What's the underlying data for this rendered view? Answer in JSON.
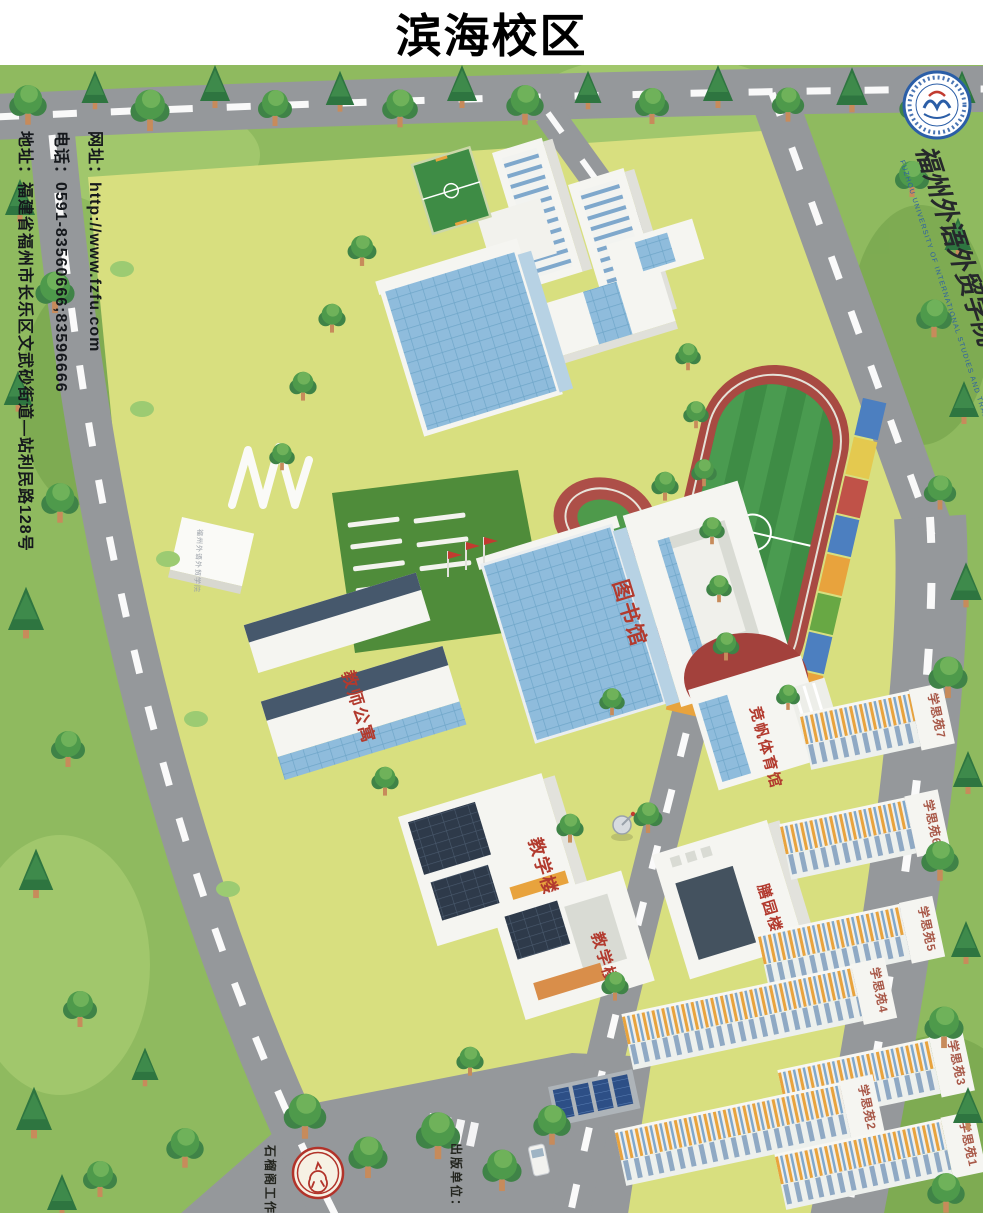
{
  "header": {
    "title": "滨海校区"
  },
  "contact": {
    "website": "网址：http://www.fzfu.com",
    "phone": "电话：0591-83560666;83596666",
    "address": "地址：福建省福州市长乐区文武砂街道—站利民路128号"
  },
  "branding": {
    "university_name": "福州外语外贸学院",
    "university_name_en": "FUZHOU UNIVERSITY OF INTERNATIONAL STUDIES AND TRADE"
  },
  "map": {
    "campus_sign": "福州外语外贸学院",
    "buildings": [
      {
        "id": "library",
        "label": "图书馆"
      },
      {
        "id": "teachers-apartment",
        "label": "教师公寓"
      },
      {
        "id": "jingfan-gymnasium",
        "label": "竞帆体育馆"
      },
      {
        "id": "teaching-building-1",
        "label": "教学楼1"
      },
      {
        "id": "teaching-building-2",
        "label": "教学楼2"
      },
      {
        "id": "dining-hall",
        "label": "膳园楼"
      },
      {
        "id": "dorm-1",
        "label": "学思苑1"
      },
      {
        "id": "dorm-2",
        "label": "学思苑2"
      },
      {
        "id": "dorm-3",
        "label": "学思苑3"
      },
      {
        "id": "dorm-4",
        "label": "学思苑4"
      },
      {
        "id": "dorm-5",
        "label": "学思苑5"
      },
      {
        "id": "dorm-6",
        "label": "学思苑6"
      },
      {
        "id": "dorm-7",
        "label": "学思苑7"
      }
    ],
    "credits": {
      "studio": "石榴阁工作室",
      "publisher": "出版单位："
    }
  },
  "colors": {
    "label_red": "#B23A2E",
    "road_gray": "#95989B",
    "campus_lawn": "#D8DF7F",
    "outer_green": "#8FBA5F",
    "logo_blue": "#2B5EA7"
  }
}
